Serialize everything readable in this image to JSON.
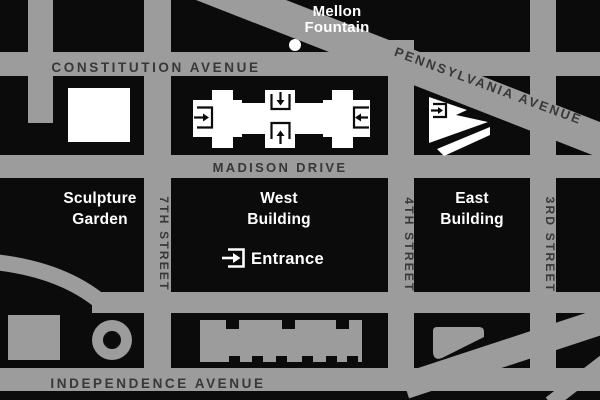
{
  "map": {
    "title": "National Gallery of Art area map",
    "colors": {
      "background": "#0c0b0b",
      "road": "#9c9c9c",
      "road_label": "#393739",
      "gallery_building": "#ffffff",
      "other_building": "#9c9c9c",
      "label": "#ffffff"
    },
    "streets": {
      "constitution": "CONSTITUTION AVENUE",
      "pennsylvania": "PENNSYLVANIA AVENUE",
      "madison": "MADISON DRIVE",
      "independence": "INDEPENDENCE AVENUE",
      "seventh": "7TH STREET",
      "fourth": "4TH STREET",
      "third": "3RD STREET"
    },
    "labels": {
      "mellon_line1": "Mellon",
      "mellon_line2": "Fountain",
      "sculpture_line1": "Sculpture",
      "sculpture_line2": "Garden",
      "west_line1": "West",
      "west_line2": "Building",
      "east_line1": "East",
      "east_line2": "Building",
      "entrance": "Entrance"
    }
  }
}
